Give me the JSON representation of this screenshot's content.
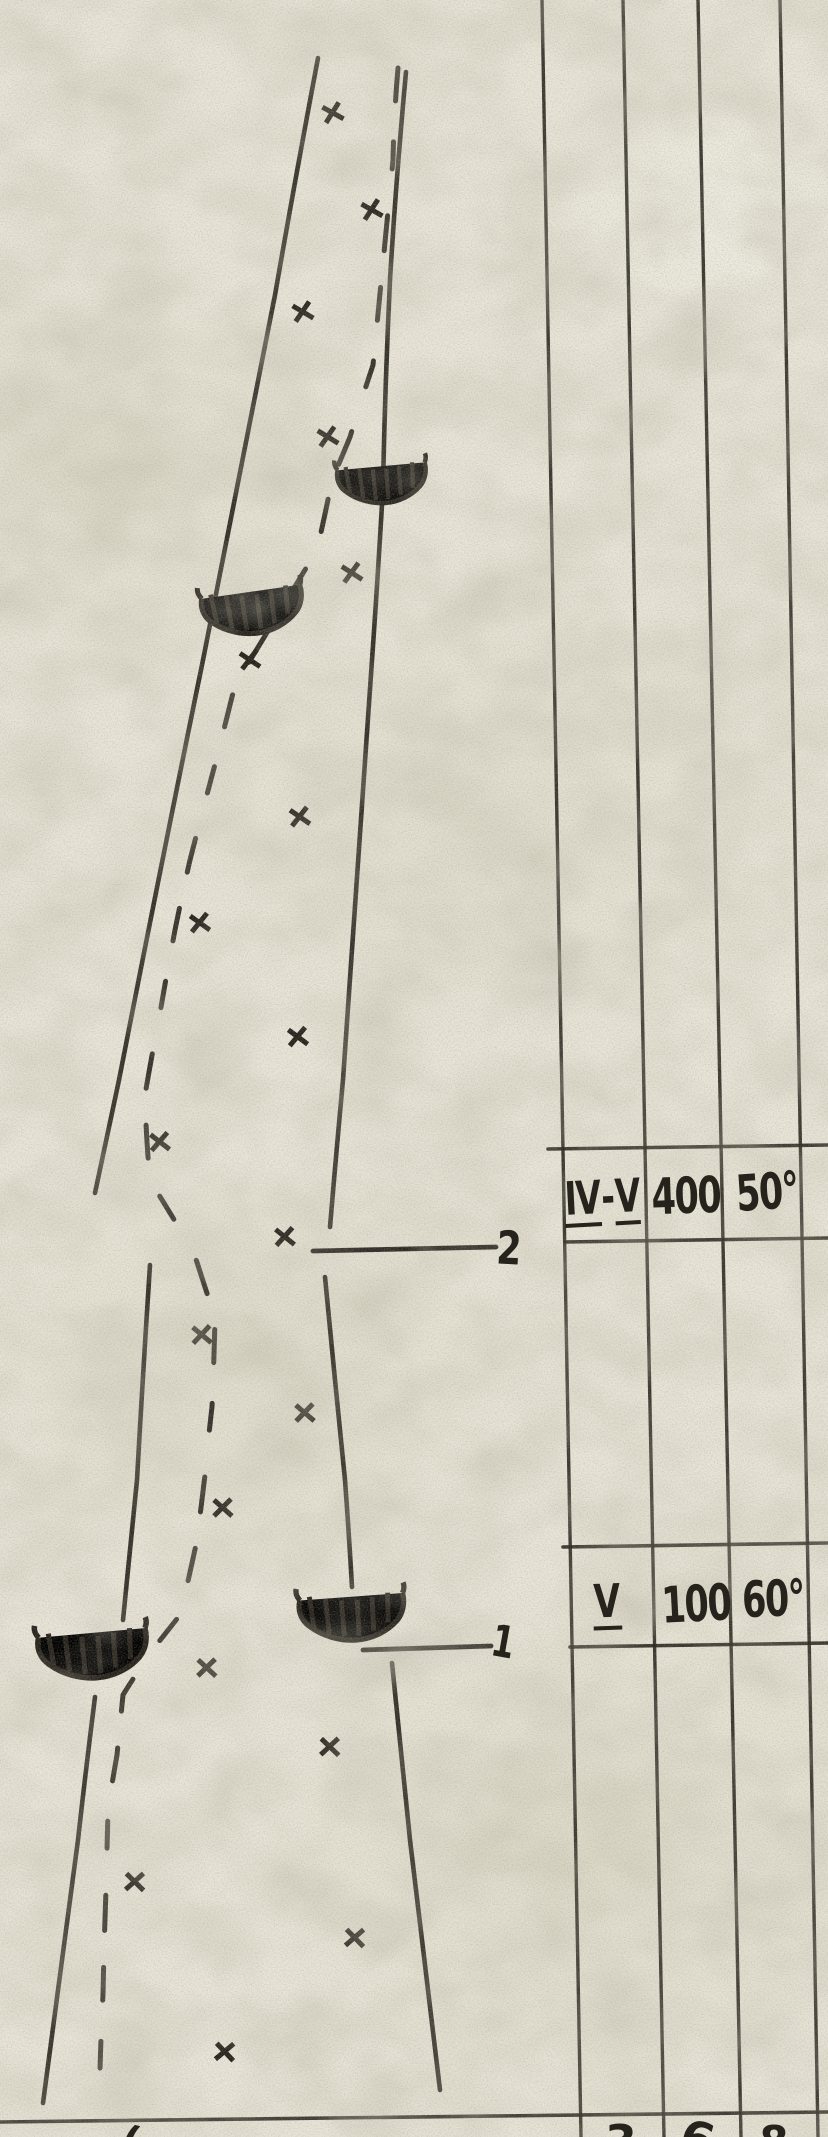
{
  "colors": {
    "paper": "#e9e6d9",
    "ink": "#26221c"
  },
  "table": {
    "rows": [
      {
        "zone_a": "IV",
        "zone_sep": "-",
        "zone_b": "V",
        "distance": "400",
        "angle": "50°"
      },
      {
        "zone_a": "V",
        "distance": "100",
        "angle": "60°"
      }
    ],
    "cutoff_row_fragments": [
      "3",
      "6",
      "8"
    ]
  },
  "map": {
    "marker_2": "2",
    "marker_1": "1",
    "cutoff_fragment_left": "(",
    "x_marks": [
      [
        333,
        113
      ],
      [
        372,
        210
      ],
      [
        303,
        312
      ],
      [
        328,
        437
      ],
      [
        352,
        573
      ],
      [
        250,
        660
      ],
      [
        300,
        817
      ],
      [
        200,
        923
      ],
      [
        298,
        1037
      ],
      [
        160,
        1142
      ],
      [
        285,
        1237
      ],
      [
        202,
        1335
      ],
      [
        305,
        1413
      ],
      [
        223,
        1508
      ],
      [
        207,
        1668
      ],
      [
        330,
        1747
      ],
      [
        135,
        1882
      ],
      [
        355,
        1938
      ],
      [
        225,
        2052
      ]
    ],
    "arcs": [
      {
        "x": 383,
        "y": 486,
        "rotate": -4,
        "scale": 0.9
      },
      {
        "x": 254,
        "y": 614,
        "rotate": -7,
        "scale": 1.02
      },
      {
        "x": 94,
        "y": 1657,
        "rotate": -4,
        "scale": 1.1
      },
      {
        "x": 353,
        "y": 1620,
        "rotate": -3,
        "scale": 1.06
      }
    ]
  }
}
